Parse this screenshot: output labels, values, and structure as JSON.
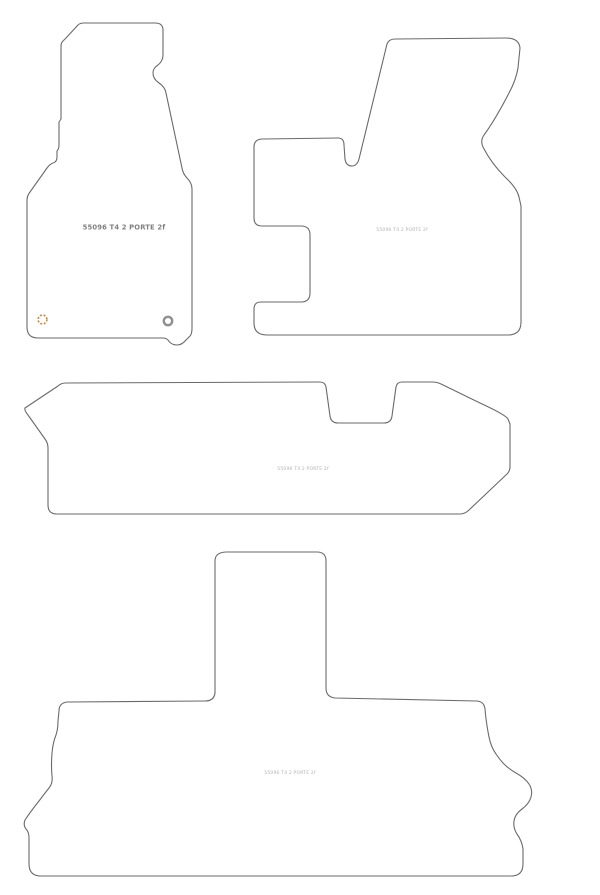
{
  "document": {
    "background_color": "#ffffff",
    "outline_color": "#6a6a6a"
  },
  "mats": [
    {
      "id": "driver-mat",
      "label": "55096 T4 2 PORTE 2f",
      "label_color": "#808080"
    },
    {
      "id": "front-passenger-mat",
      "label": "55096 T4 2 PORTE 2f",
      "label_color": "#b4b4b4"
    },
    {
      "id": "rear-bench-mat",
      "label": "55096 T4 2 PORTE 2f",
      "label_color": "#b4b4b4"
    },
    {
      "id": "boot-mat",
      "label": "55096 T4 2 PORTE 2f",
      "label_color": "#b4b4b4"
    }
  ],
  "grommets": {
    "left": {
      "color": "#c08a4e"
    },
    "right": {
      "color": "#8f8f8f"
    }
  }
}
